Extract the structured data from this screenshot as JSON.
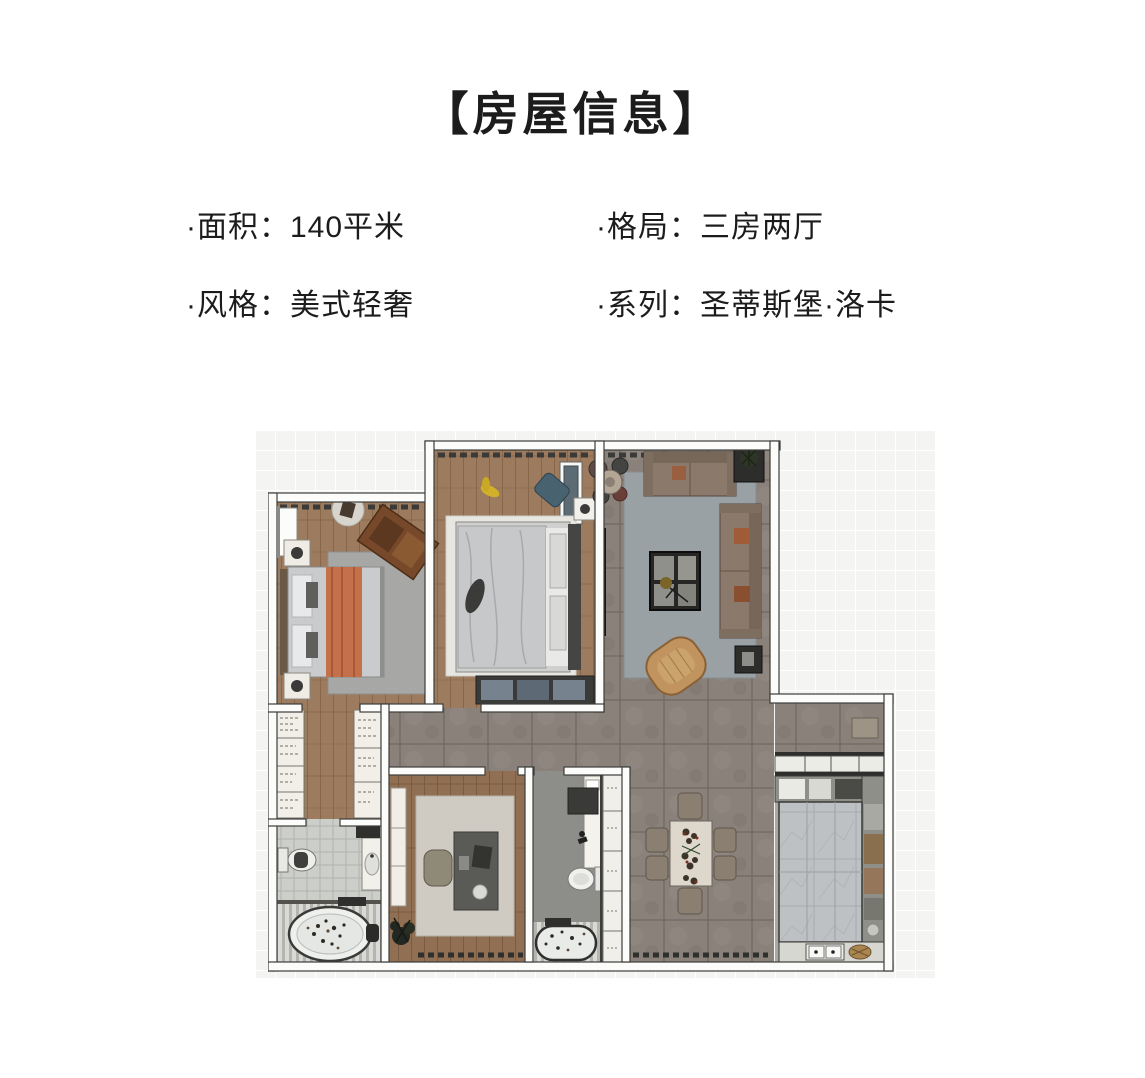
{
  "header": {
    "title": "【房屋信息】"
  },
  "info": {
    "items": [
      {
        "text": "·面积：140平米"
      },
      {
        "text": "·格局：三房两厅"
      },
      {
        "text": "·风格：美式轻奢"
      },
      {
        "text": "·系列：圣蒂斯堡·洛卡"
      }
    ]
  },
  "colors": {
    "text": "#1c1c1c",
    "background": "#ffffff",
    "backdrop": "#f4f4f2",
    "wall": "#fcfcfa",
    "wall_line": "#3d3d3b",
    "wood_floor": "#9c7b5e",
    "study_floor": "#906f53",
    "tile_floor": "#8a817a",
    "bath_tile": "#cbcec9",
    "marble_floor": "#bdc1c3",
    "rug_gray": "#9aa1a5",
    "rug_light": "#e8e6e0",
    "sofa": "#8b7a6c",
    "accent_chair": "#c0935f",
    "blanket_orange": "#c4704a",
    "cabinet_wood": "#8a6f4e",
    "dark_furniture": "#2d2d2b"
  }
}
